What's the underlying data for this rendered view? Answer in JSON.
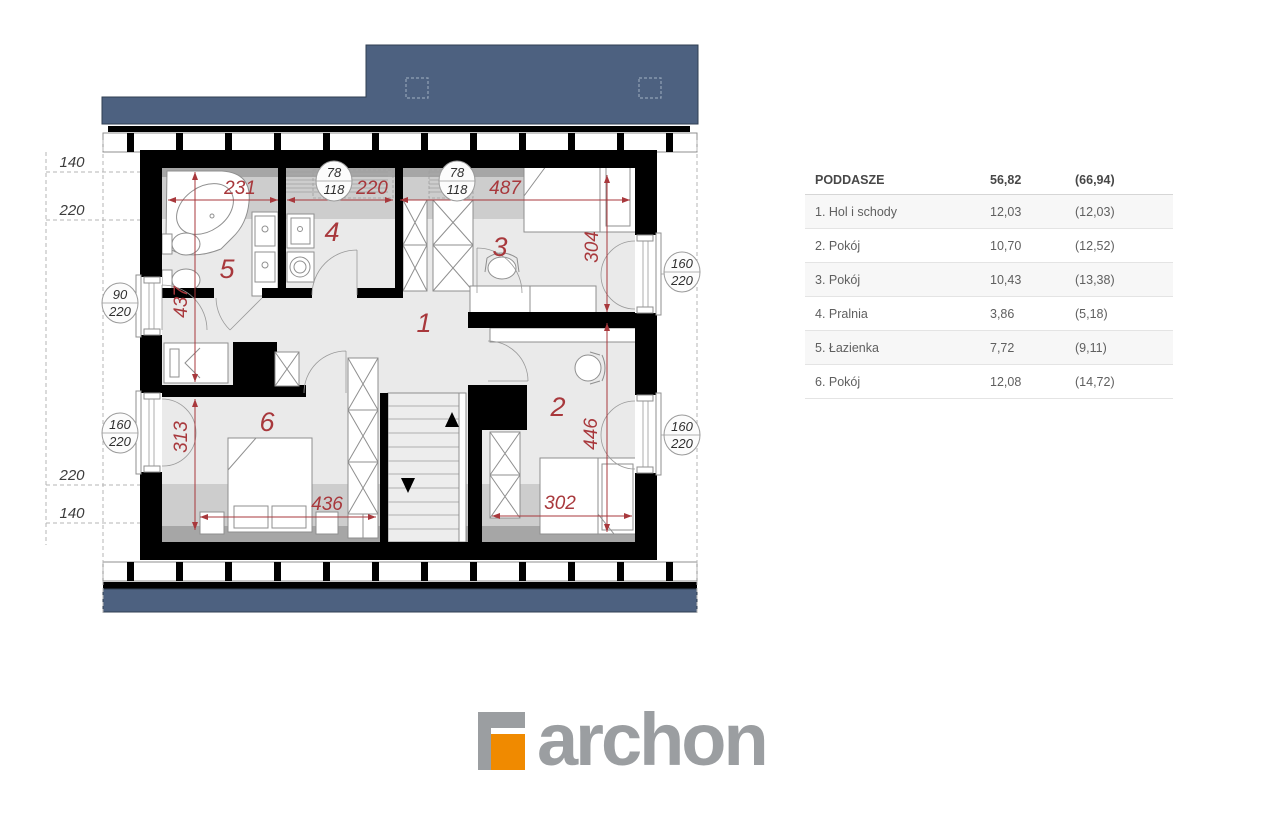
{
  "plan": {
    "height_labels": {
      "top_140": "140",
      "top_220": "220",
      "bottom_220": "220",
      "bottom_140": "140"
    },
    "room_numbers": {
      "hall": "1",
      "room2": "2",
      "room3": "3",
      "pralnia": "4",
      "lazienka": "5",
      "room6": "6"
    },
    "dimensions": {
      "bath_width": "231",
      "pralnia_width": "220",
      "room3_width": "487",
      "room3_depth": "304",
      "bath_depth": "437",
      "room6_depth": "313",
      "room6_width": "436",
      "room2_width": "302",
      "room2_depth": "446"
    },
    "window_markers": {
      "skylight_left": {
        "top": "78",
        "bottom": "118"
      },
      "skylight_right": {
        "top": "78",
        "bottom": "118"
      },
      "left_upper": {
        "top": "90",
        "bottom": "220"
      },
      "left_lower": {
        "top": "160",
        "bottom": "220"
      },
      "right_upper": {
        "top": "160",
        "bottom": "220"
      },
      "right_lower": {
        "top": "160",
        "bottom": "220"
      }
    }
  },
  "legend": {
    "header": {
      "name": "PODDASZE",
      "area": "56,82",
      "area_gross": "(66,94)"
    },
    "rows": [
      {
        "name": "1. Hol i schody",
        "area": "12,03",
        "area_gross": "(12,03)"
      },
      {
        "name": "2. Pokój",
        "area": "10,70",
        "area_gross": "(12,52)"
      },
      {
        "name": "3. Pokój",
        "area": "10,43",
        "area_gross": "(13,38)"
      },
      {
        "name": "4. Pralnia",
        "area": "3,86",
        "area_gross": "(5,18)"
      },
      {
        "name": "5. Łazienka",
        "area": "7,72",
        "area_gross": "(9,11)"
      },
      {
        "name": "6. Pokój",
        "area": "12,08",
        "area_gross": "(14,72)"
      }
    ]
  },
  "logo": {
    "text": "archon"
  },
  "colors": {
    "roof": "#4d6180",
    "dimension_red": "#a8383c",
    "logo_orange": "#f08a00",
    "logo_gray": "#9b9ea1"
  }
}
